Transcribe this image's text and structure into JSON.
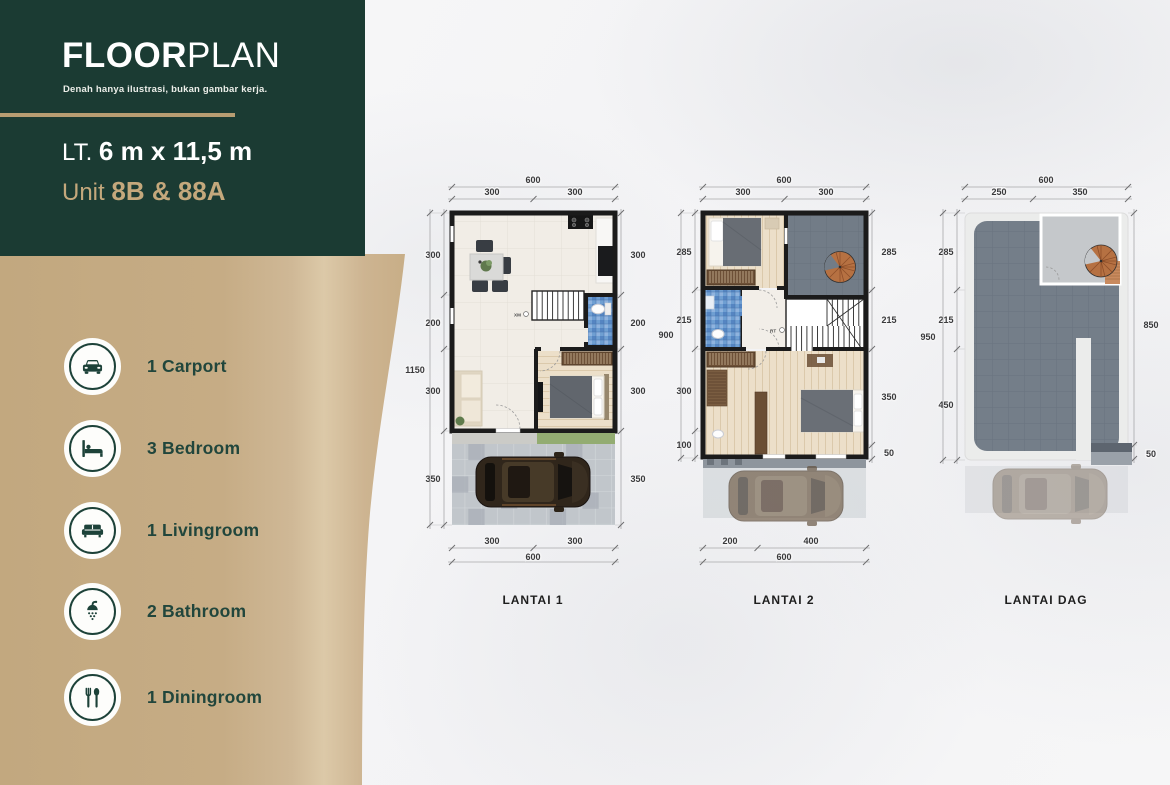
{
  "brand": {
    "title_bold": "FLOOR",
    "title_light": "PLAN",
    "subtitle": "Denah hanya ilustrasi, bukan gambar kerja.",
    "lot_prefix": "LT.",
    "lot_size": "6 m x 11,5 m",
    "unit_prefix": "Unit",
    "unit_value": "8B & 88A"
  },
  "amenities": [
    {
      "icon": "car-icon",
      "label": "1 Carport"
    },
    {
      "icon": "bed-icon",
      "label": "3 Bedroom"
    },
    {
      "icon": "sofa-icon",
      "label": "1 Livingroom"
    },
    {
      "icon": "shower-icon",
      "label": "2 Bathroom"
    },
    {
      "icon": "cutlery-icon",
      "label": "1 Diningroom"
    }
  ],
  "plans": [
    {
      "name": "LANTAI 1",
      "top_overall": "600",
      "top_segments": [
        "300",
        "300"
      ],
      "bottom_overall": "600",
      "bottom_segments": [
        "300",
        "300"
      ],
      "left_overall": "1150",
      "left_segments": [
        "300",
        "200",
        "300",
        "350"
      ],
      "right_segments": [
        "300",
        "200",
        "300",
        "350"
      ],
      "stair_label": "XM"
    },
    {
      "name": "LANTAI 2",
      "top_overall": "600",
      "top_segments": [
        "300",
        "300"
      ],
      "bottom_overall": "600",
      "bottom_segments": [
        "200",
        "400"
      ],
      "left_overall": "900",
      "left_segments": [
        "285",
        "215",
        "300",
        "100"
      ],
      "right_segments": [
        "285",
        "215",
        "350",
        "50"
      ],
      "stair_label": "RT"
    },
    {
      "name": "LANTAI DAG",
      "top_overall": "600",
      "top_segments": [
        "250",
        "350"
      ],
      "left_overall": "950",
      "left_segments": [
        "285",
        "215",
        "450"
      ],
      "right_segments": [
        "850",
        "50"
      ]
    }
  ],
  "colors": {
    "brand_green": "#1b3b33",
    "accent_gold": "#c4a87c",
    "panel_tan": "#c6ac85",
    "wall_black": "#1b1b1b",
    "bathroom_blue": "#6f9fd2",
    "roof_gray": "#747e89",
    "grass_green": "#93ac72",
    "wood_floor": "#ecdfc9"
  }
}
